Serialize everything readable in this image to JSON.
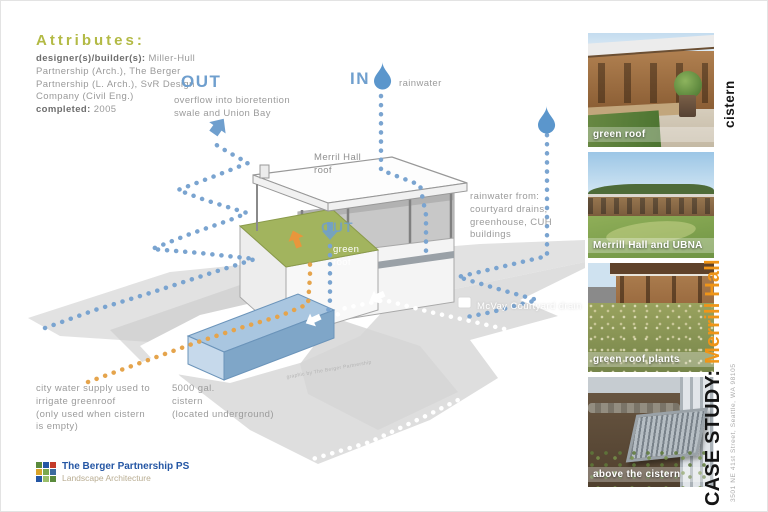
{
  "attributes": {
    "heading": "Attributes:",
    "designer_label": "designer(s)/builder(s):",
    "designer_value": "Miller-Hull Partnership (Arch.), The Berger Partnership (L. Arch.), SvR Design Company (Civil Eng.)",
    "completed_label": "completed:",
    "completed_value": "2005"
  },
  "diagram": {
    "out_label": "OUT",
    "out_desc": "overflow into bioretention\nswale and Union Bay",
    "in_label": "IN",
    "in_desc": "rainwater",
    "roof_label": "Merril Hall\nroof",
    "rainwater_from": "rainwater from:\ncourtyard drains,\ngreenhouse, CUH\nbuildings",
    "mcvay_label": "McVay Courtyard drain",
    "green_roof_out_label": "OUT",
    "green_roof_label": "green\nroof",
    "city_water_label": "city water supply used to\nirrigate greenroof\n(only used when cistern\nis empty)",
    "cistern_caption": "5000 gal.\ncistern\n(located underground)",
    "credit": "graphic by The Berger Partnership"
  },
  "logo": {
    "company": "The Berger Partnership PS",
    "tagline": "Landscape Architecture"
  },
  "sidebar": {
    "photos": [
      {
        "label": "green roof"
      },
      {
        "label": "Merrill Hall and UBNA"
      },
      {
        "label": "green roof plants"
      },
      {
        "label": "above the cistern"
      }
    ]
  },
  "case_study": {
    "side_label": "cistern",
    "prefix": "CASE STUDY: ",
    "title": "Merrill Hall",
    "address": "3501 NE 41st Street, Seattle, WA 98105"
  },
  "colors": {
    "accent_blue": "#6f9fce",
    "accent_orange": "#e5a44c",
    "green_roof": "#a2b45e",
    "title_orange": "#ef9518",
    "logo_blue": "#2456a4",
    "attr_olive": "#b3ba45"
  }
}
